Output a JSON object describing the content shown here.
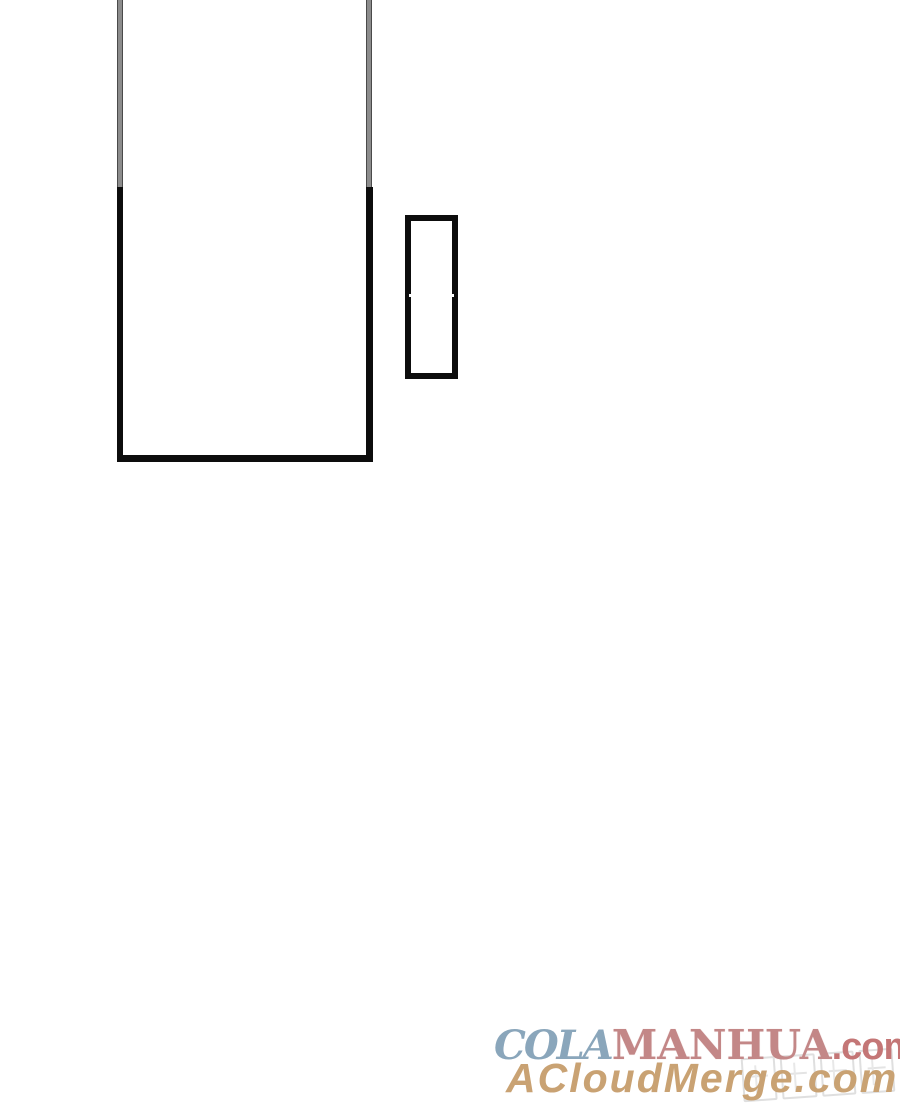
{
  "page": {
    "background_color": "#ffffff",
    "type": "comic-page-bottom"
  },
  "comic": {
    "border_color": "#0d0d0d",
    "faded_border_color": "#8c8c8c",
    "panels": [
      {
        "name": "main-panel",
        "content": ""
      },
      {
        "name": "side-panel",
        "content": ""
      }
    ]
  },
  "watermark": {
    "line1": {
      "cola": "COLA",
      "manhua": "MANHUA",
      "suffix": ".com",
      "cola_color": "#8aa6bb",
      "manhua_color": "#c38787",
      "suffix_color": "#c47676"
    },
    "line2": {
      "text": "ACloudMerge.com",
      "color": "#c9a273"
    },
    "stamp": {
      "name": "pixel-logo-stamp",
      "color": "#dcdcdc"
    }
  }
}
